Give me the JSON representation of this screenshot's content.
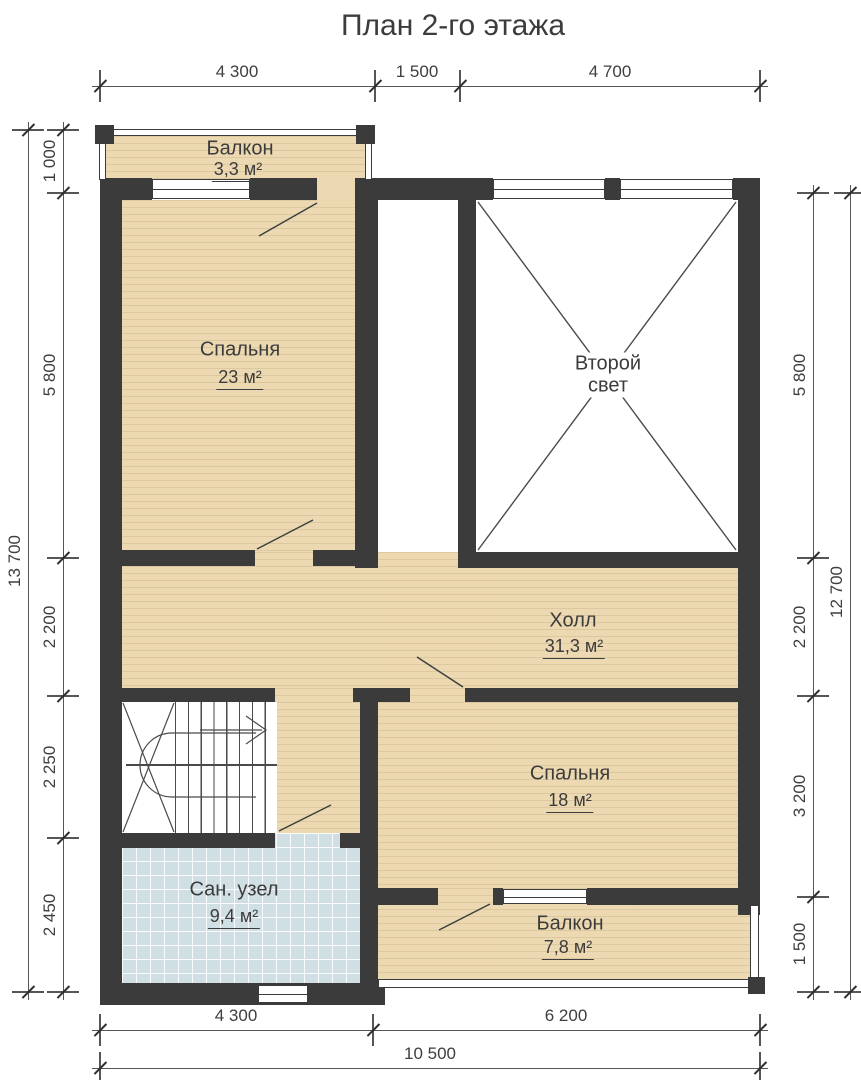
{
  "title": "План 2-го этажа",
  "rooms": {
    "balcony_top": {
      "name": "Балкон",
      "area": "3,3 м²"
    },
    "bedroom_large": {
      "name": "Спальня",
      "area": "23 м²"
    },
    "second_light": {
      "name_line1": "Второй",
      "name_line2": "свет"
    },
    "hall": {
      "name": "Холл",
      "area": "31,3 м²"
    },
    "bedroom_small": {
      "name": "Спальня",
      "area": "18 м²"
    },
    "bathroom": {
      "name": "Сан. узел",
      "area": "9,4 м²"
    },
    "balcony_bottom": {
      "name": "Балкон",
      "area": "7,8 м²"
    }
  },
  "dimensions": {
    "top": [
      "4 300",
      "1 500",
      "4 700"
    ],
    "left": [
      "1 000",
      "5 800",
      "2 200",
      "2 250",
      "2 450"
    ],
    "left_total": "13 700",
    "right": [
      "5 800",
      "2 200",
      "3 200",
      "1 500"
    ],
    "right_total": "12 700",
    "bottom": [
      "4 300",
      "6 200"
    ],
    "bottom_total": "10 500"
  },
  "colors": {
    "wall": "#3b3b3b",
    "wood_floor": "#ecd9b2",
    "tile_floor": "#cfdfe4",
    "dim_line": "#565656"
  }
}
